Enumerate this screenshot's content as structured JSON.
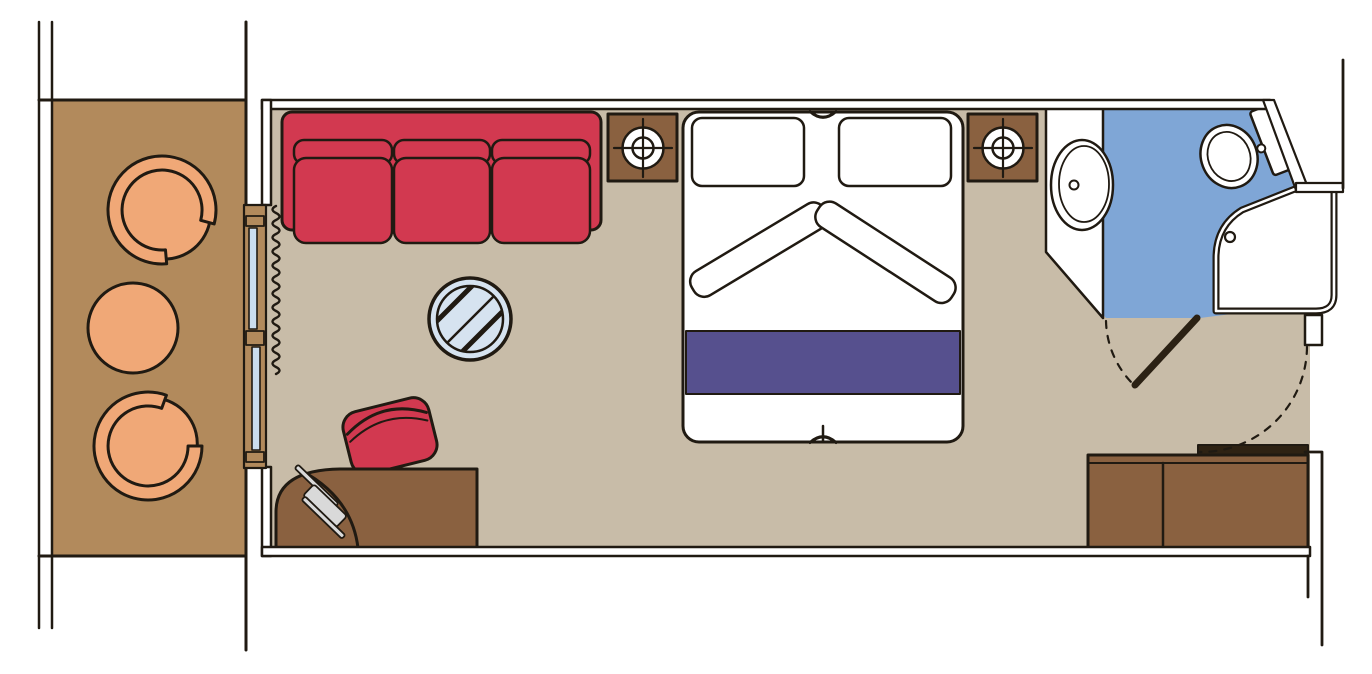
{
  "canvas": {
    "width": 1372,
    "height": 674
  },
  "plan": {
    "type": "floor-plan",
    "description_elements": [
      "ship-hull",
      "balcony",
      "balcony-armchair-top",
      "balcony-armchair-bottom",
      "balcony-round-table",
      "sliding-glass-door",
      "curtain",
      "cabin",
      "sofa-three-seat",
      "glass-coffee-table",
      "red-stool",
      "desk",
      "hairdryer",
      "nightstand-left",
      "lamp-left",
      "nightstand-right",
      "lamp-right",
      "double-bed",
      "pillows",
      "bed-runner",
      "bathroom",
      "vanity-sink",
      "toilet",
      "shower",
      "bathroom-door",
      "entrance-door",
      "wardrobe",
      "corridor-wall"
    ]
  },
  "colors": {
    "outline": "#201a12",
    "balcony_floor": "#b28a5c",
    "cabin_floor": "#c8bca8",
    "bathroom_floor": "#7fa6d6",
    "upholstery_red": "#d23950",
    "bed_runner_purple": "#56508e",
    "wood_furniture": "#8a6140",
    "wood_dark_ledge": "#2e2213",
    "door_leaf_dark": "#2b2114",
    "glass_blue": "#d6e3f0",
    "window_pane_blue": "#cbddee",
    "seat_peach": "#f0a877",
    "metal_gray": "#d9d9d9",
    "wall_white": "#ffffff"
  }
}
